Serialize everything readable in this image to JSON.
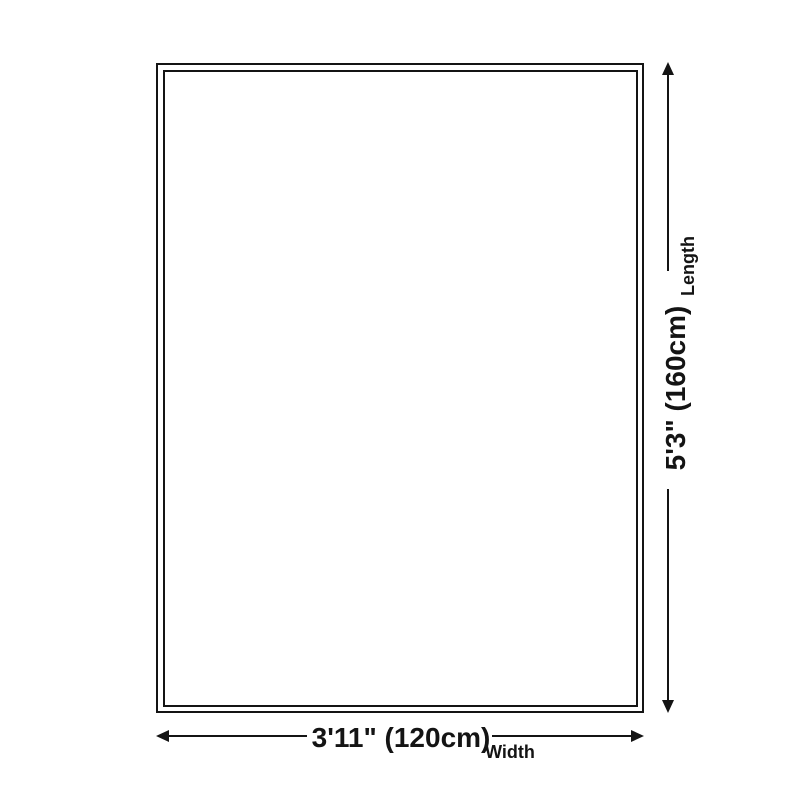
{
  "colors": {
    "background": "#ffffff",
    "line": "#141414",
    "text": "#141414"
  },
  "rug_diagram": {
    "length": {
      "value": "5'3\" (160cm)",
      "label": "Length"
    },
    "width": {
      "value": "3'11\" (120cm)",
      "label": "Width"
    }
  },
  "icons": {
    "arrow_up": "triangle-up",
    "arrow_down": "triangle-down",
    "arrow_left": "triangle-left",
    "arrow_right": "triangle-right"
  }
}
